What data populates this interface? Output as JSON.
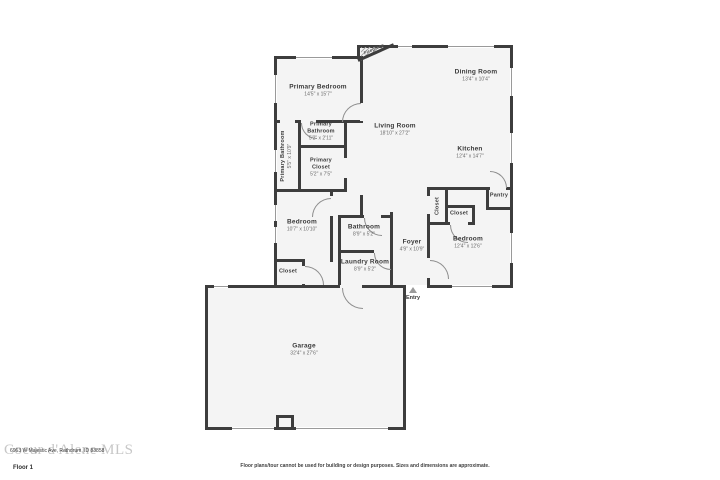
{
  "floorplan": {
    "colors": {
      "wall": "#3d3d3d",
      "room_fill": "#f4f4f4",
      "window_line": "#9a9a9a"
    },
    "labels": {
      "primary_bedroom": {
        "name": "Primary Bedroom",
        "dims": "14'5\" x 15'7\""
      },
      "primary_bathroom_small": {
        "name": "Primary Bathroom",
        "dims": "5'2\" x 2'11\""
      },
      "primary_bathroom": {
        "name": "Primary Bathroom",
        "dims": "5'5\" x 10'9\""
      },
      "primary_closet": {
        "name": "Primary Closet",
        "dims": "5'2\" x 7'5\""
      },
      "living_room": {
        "name": "Living Room",
        "dims": "18'10\" x 27'2\""
      },
      "dining_room": {
        "name": "Dining Room",
        "dims": "13'4\" x 10'4\""
      },
      "kitchen": {
        "name": "Kitchen",
        "dims": "12'4\" x 14'7\""
      },
      "pantry": {
        "name": "Pantry"
      },
      "closet_left": {
        "name": "Closet"
      },
      "closet_foyer": {
        "name": "Closet"
      },
      "closet_bedroom": {
        "name": "Closet"
      },
      "bedroom_left": {
        "name": "Bedroom",
        "dims": "10'7\" x 10'10\""
      },
      "bedroom_right": {
        "name": "Bedroom",
        "dims": "12'4\" x 12'6\""
      },
      "bathroom": {
        "name": "Bathroom",
        "dims": "8'9\" x 5'2\""
      },
      "laundry_room": {
        "name": "Laundry Room",
        "dims": "8'9\" x 5'2\""
      },
      "foyer": {
        "name": "Foyer",
        "dims": "4'9\" x 10'9\""
      },
      "garage": {
        "name": "Garage",
        "dims": "32'4\" x 27'6\""
      },
      "fireplace": {
        "name": "Fireplace"
      },
      "entry": {
        "name": "Entry"
      }
    }
  },
  "footer": {
    "watermark": "Coeur d'Alene MLS",
    "address": "6963 W Majestic Ave, Rathdrum, ID 83858",
    "floor_label": "Floor 1",
    "disclaimer": "Floor plans/tour cannot be used for building or design purposes. Sizes and dimensions are approximate."
  }
}
